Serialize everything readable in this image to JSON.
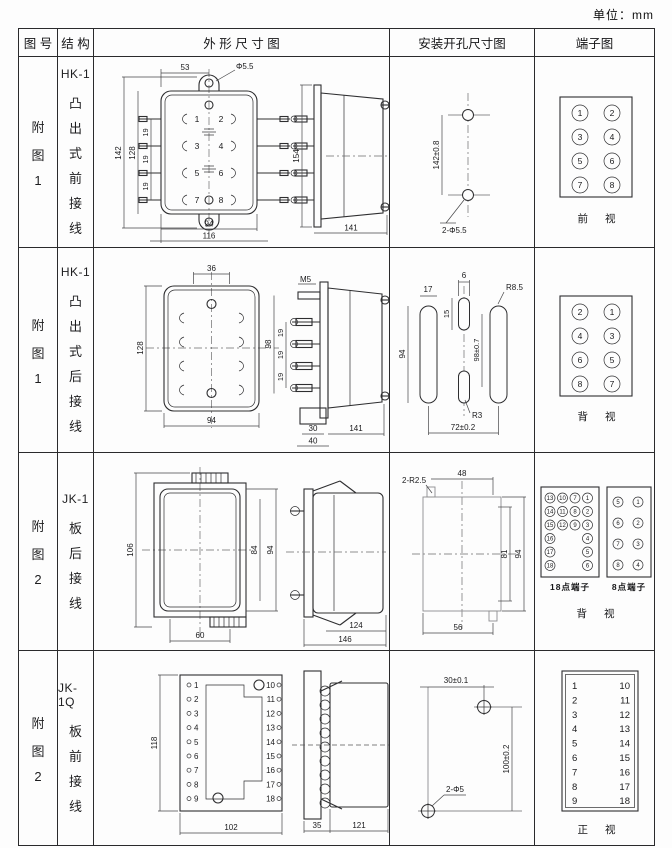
{
  "page": {
    "unit_label": "单位：mm"
  },
  "header": {
    "figure": "图 号",
    "structure": "结 构",
    "outline": "外 形 尺 寸 图",
    "mounting": "安装开孔尺寸图",
    "terminal": "端子图"
  },
  "rows": [
    {
      "figure_chars": [
        "附",
        "图",
        "1"
      ],
      "model": "HK-1",
      "structure_chars": [
        "凸",
        "出",
        "式",
        "前",
        "接",
        "线"
      ],
      "outline": {
        "front": {
          "dim_top": "53",
          "hole_label": "Φ5.5",
          "dim_h_outer": "142",
          "dim_h_inner": "128",
          "pitch": [
            "19",
            "19",
            "19"
          ],
          "dim_w_inner": "94",
          "dim_w_outer": "116",
          "terminals": [
            "1",
            "2",
            "3",
            "4",
            "5",
            "6",
            "7",
            "8"
          ]
        },
        "side": {
          "dim_h": "154",
          "dim_w": "141"
        }
      },
      "mounting": {
        "dim_v": "142±0.8",
        "holes": "2-Φ5.5"
      },
      "terminal": {
        "left": [
          "1",
          "3",
          "5",
          "7"
        ],
        "right": [
          "2",
          "4",
          "6",
          "8"
        ],
        "caption": "前 视"
      }
    },
    {
      "figure_chars": [
        "附",
        "图",
        "1"
      ],
      "model": "HK-1",
      "structure_chars": [
        "凸",
        "出",
        "式",
        "后",
        "接",
        "线"
      ],
      "outline": {
        "front": {
          "dim_top": "36",
          "dim_h": "128",
          "dim_w": "94"
        },
        "side": {
          "screw_label": "M5",
          "dim_h": "98",
          "pitch": [
            "19",
            "19",
            "19"
          ],
          "dim_base_inner": "30",
          "dim_base_outer": "40",
          "dim_w": "141"
        }
      },
      "mounting": {
        "slot_w": "17",
        "slot_c_w": "6",
        "slot_c_h": "15",
        "slot_h": "94",
        "dim_v": "98±0.7",
        "radius_outer": "R8.5",
        "radius_center": "R3",
        "dim_span": "72±0.2"
      },
      "terminal": {
        "left": [
          "2",
          "4",
          "6",
          "8"
        ],
        "right": [
          "1",
          "3",
          "5",
          "7"
        ],
        "caption": "背 视"
      }
    },
    {
      "figure_chars": [
        "附",
        "图",
        "2"
      ],
      "model": "JK-1",
      "structure_chars": [
        "板",
        "后",
        "接",
        "线"
      ],
      "outline": {
        "front": {
          "dim_h_outer": "106",
          "dim_h_inner": "84",
          "dim_h_mid": "94",
          "dim_w": "60"
        },
        "side": {
          "dim_w_inner": "124",
          "dim_w_outer": "146"
        }
      },
      "mounting": {
        "notch_label": "2-R2.5",
        "dim_top": "48",
        "dim_h_inner": "81",
        "dim_h_outer": "94",
        "dim_w": "56"
      },
      "terminal": {
        "grid18": {
          "col1": [
            "13",
            "14",
            "15",
            "16",
            "17",
            "18"
          ],
          "col2": [
            "10",
            "11",
            "12"
          ],
          "col3": [
            "7",
            "8",
            "9"
          ],
          "col4": [
            "1",
            "2",
            "3",
            "4",
            "5",
            "6"
          ],
          "caption": "18点端子"
        },
        "grid8": {
          "left": [
            "5",
            "6",
            "7",
            "8"
          ],
          "right": [
            "1",
            "2",
            "3",
            "4"
          ],
          "caption": "8点端子"
        },
        "caption": "背 视"
      }
    },
    {
      "figure_chars": [
        "附",
        "图",
        "2"
      ],
      "model": "JK-1Q",
      "structure_chars": [
        "板",
        "前",
        "接",
        "线"
      ],
      "outline": {
        "front": {
          "dim_h": "118",
          "dim_w": "102",
          "left_terms": [
            "1",
            "2",
            "3",
            "4",
            "5",
            "6",
            "7",
            "8",
            "9"
          ],
          "right_terms": [
            "10",
            "11",
            "12",
            "13",
            "14",
            "15",
            "16",
            "17",
            "18"
          ]
        },
        "side": {
          "dim_plate": "35",
          "dim_body": "121"
        }
      },
      "mounting": {
        "dim_top": "30±0.1",
        "dim_v": "100±0.2",
        "holes": "2-Φ5"
      },
      "terminal": {
        "left": [
          "1",
          "2",
          "3",
          "4",
          "5",
          "6",
          "7",
          "8",
          "9"
        ],
        "right": [
          "10",
          "11",
          "12",
          "13",
          "14",
          "15",
          "16",
          "17",
          "18"
        ],
        "caption": "正 视"
      }
    }
  ]
}
